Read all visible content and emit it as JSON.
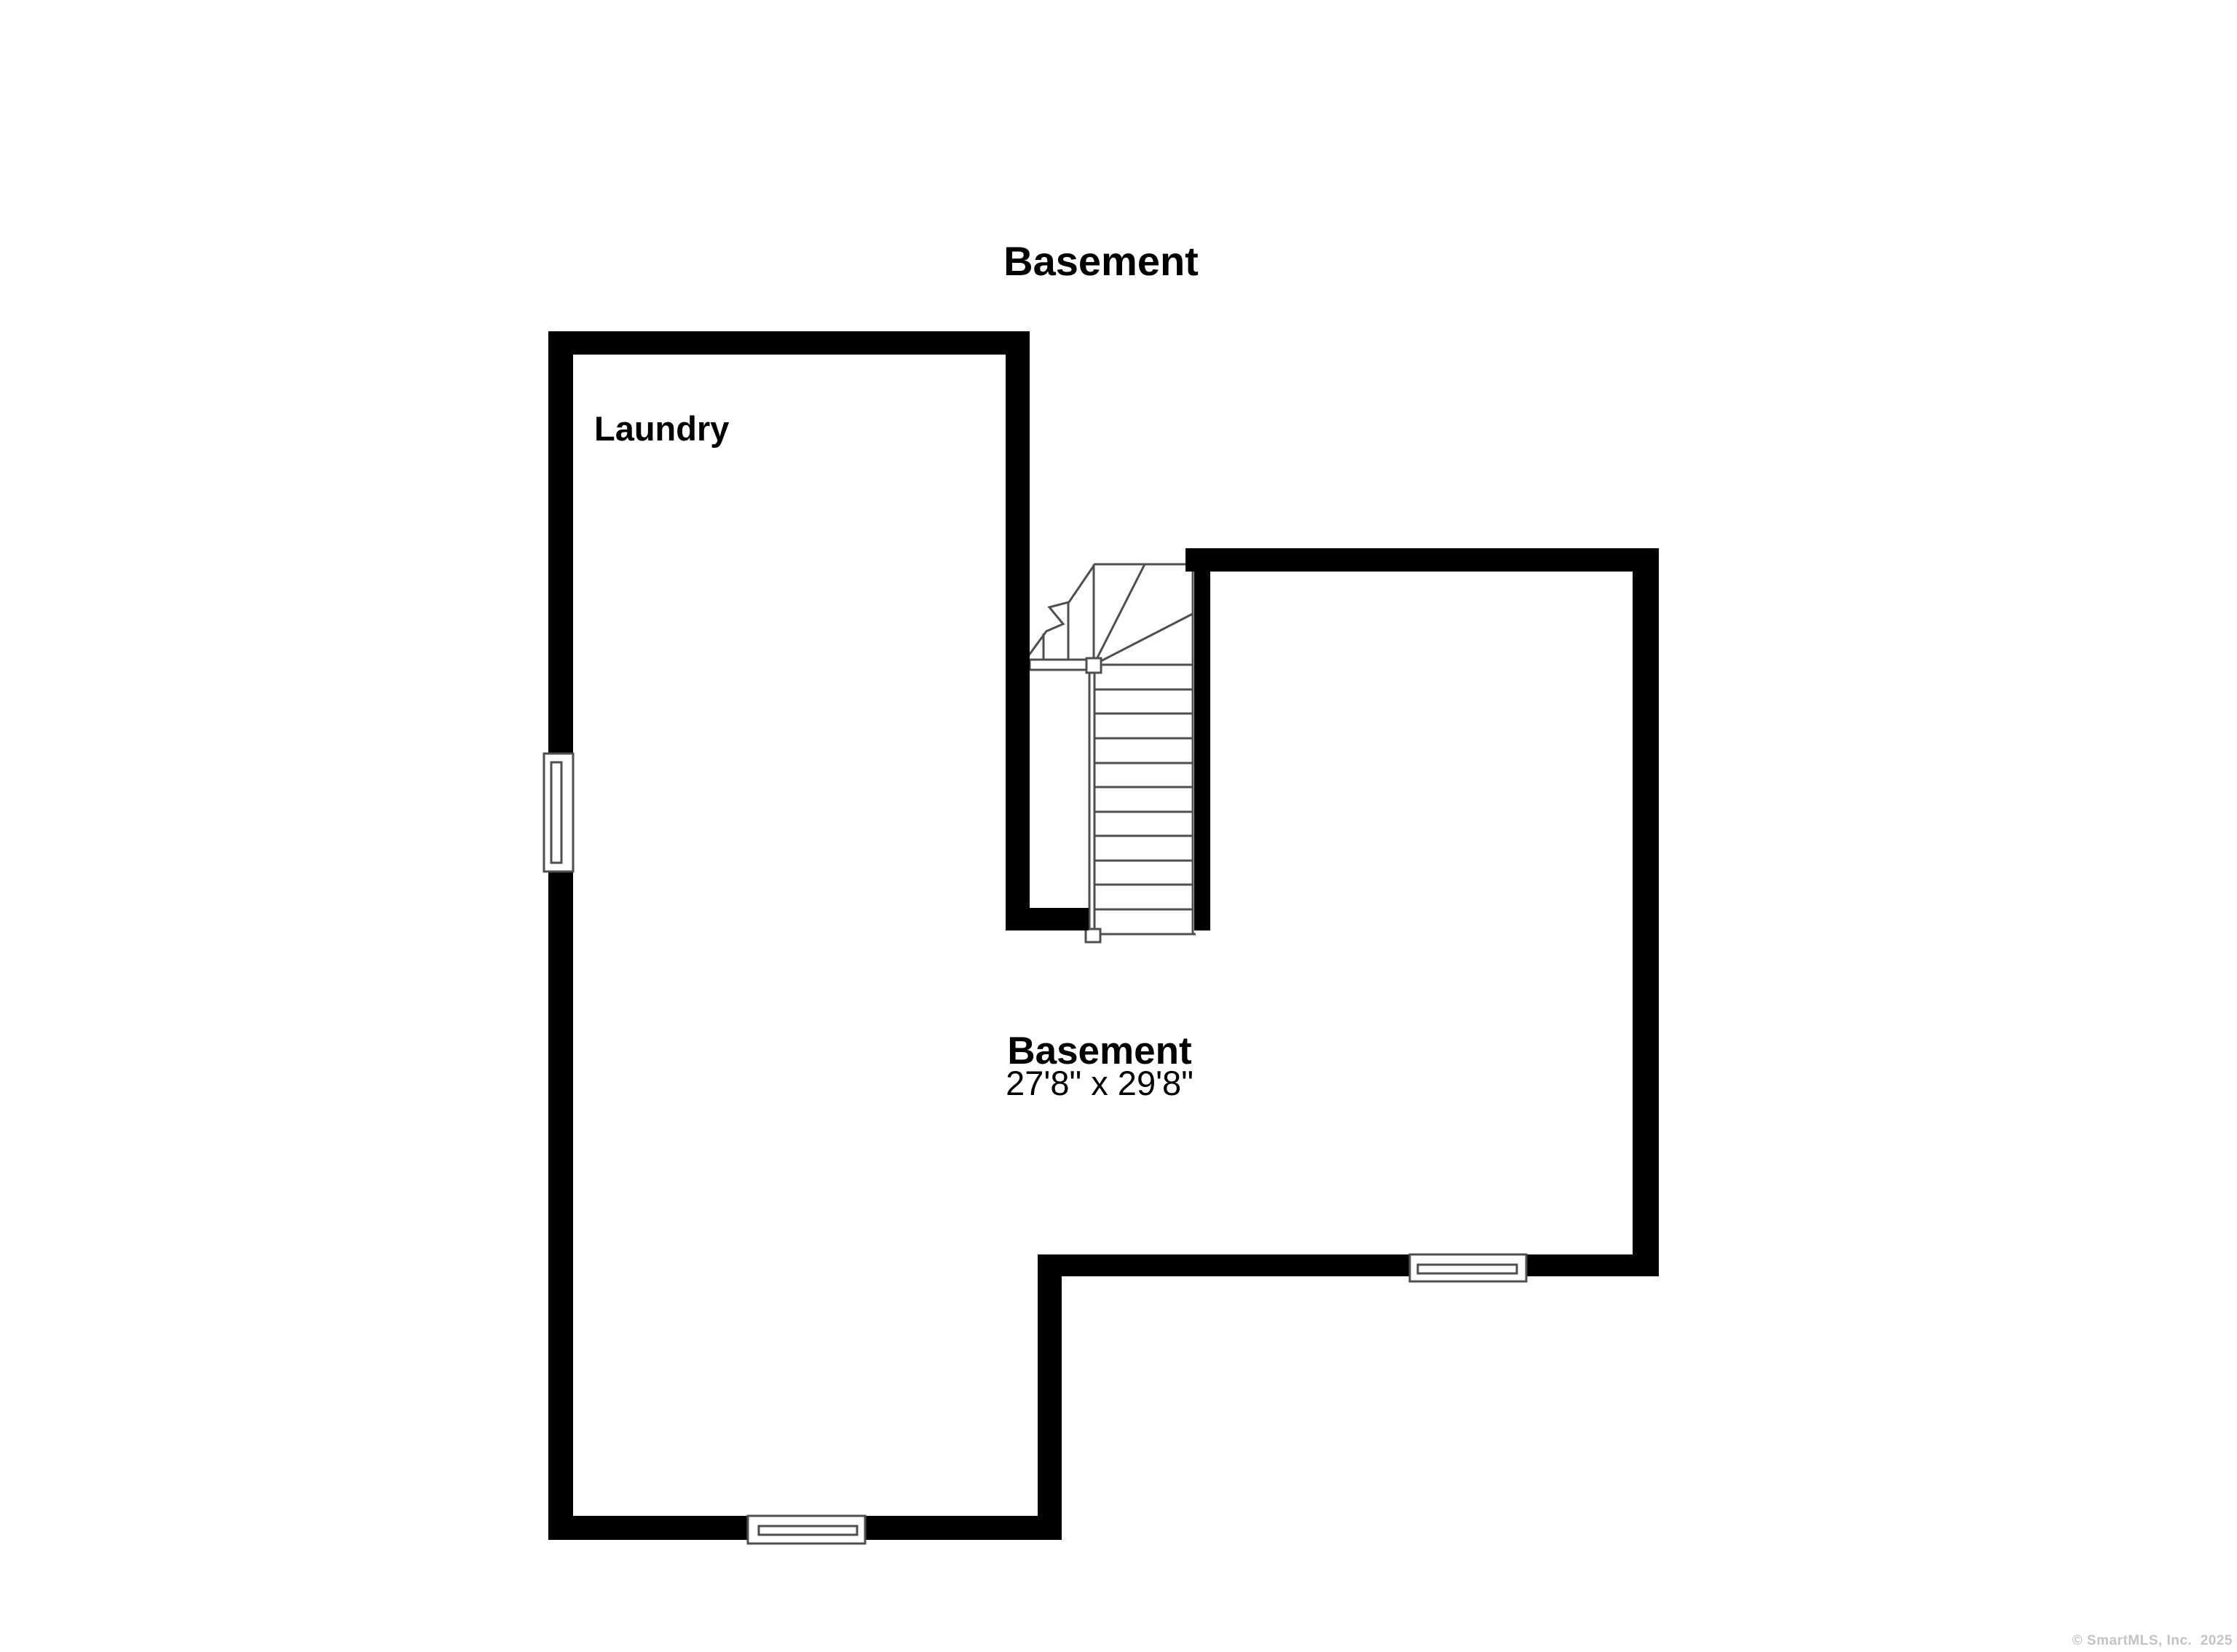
{
  "title": "Basement",
  "rooms": {
    "laundry": {
      "label": "Laundry"
    },
    "basement": {
      "label": "Basement",
      "dimensions": "27'8\" x 29'8\""
    }
  },
  "footer": {
    "copyright": "© SmartMLS, Inc.  2025"
  },
  "colors": {
    "wall": "#000000",
    "line": "#4f4f4f",
    "background": "#ffffff",
    "copyright": "#c3c3c3",
    "text": "#000000"
  }
}
